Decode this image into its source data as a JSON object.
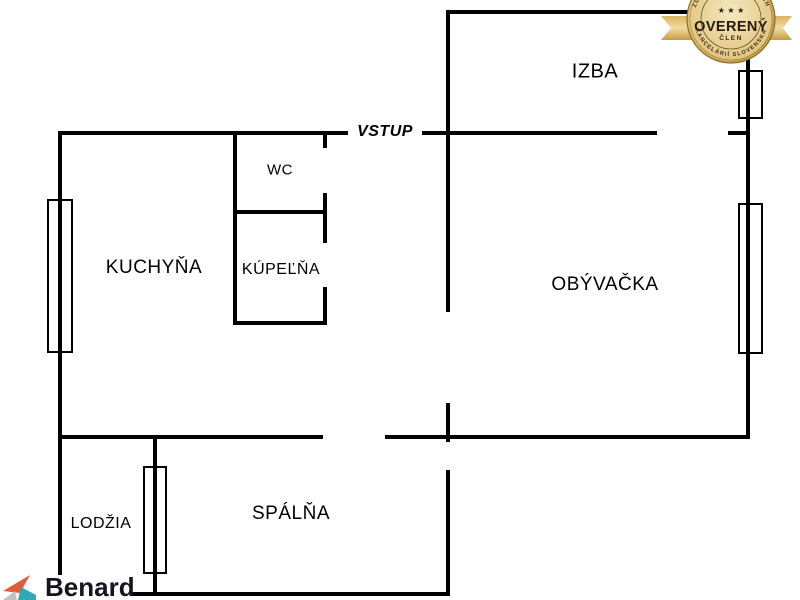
{
  "rooms": {
    "izba": "IZBA",
    "vstup": "VSTUP",
    "wc": "WC",
    "kuchyna": "KUCHYŇA",
    "kupelna": "KÚPEĽŇA",
    "obyvacka": "OBÝVAČKA",
    "lodzia": "LODŽIA",
    "spalna": "SPÁLŇA"
  },
  "badge": {
    "stars": "★ ★ ★",
    "title": "OVERENÝ",
    "member": "ČLEN",
    "arc_top": "ZDRUŽENIA REALITNÝCH",
    "arc_bottom": "KANCELÁRIÍ SLOVENSKA"
  },
  "logo": {
    "name": "Benard"
  },
  "colors": {
    "wall": "#000000",
    "background": "#ffffff",
    "badge_gold_dark": "#b8923f",
    "badge_gold_light": "#f0dcab",
    "badge_text": "#2b2110",
    "logo_orange": "#e25c3b",
    "logo_teal": "#2fa9b4",
    "logo_gray": "#c2c2c2",
    "logo_text": "#15151f"
  }
}
